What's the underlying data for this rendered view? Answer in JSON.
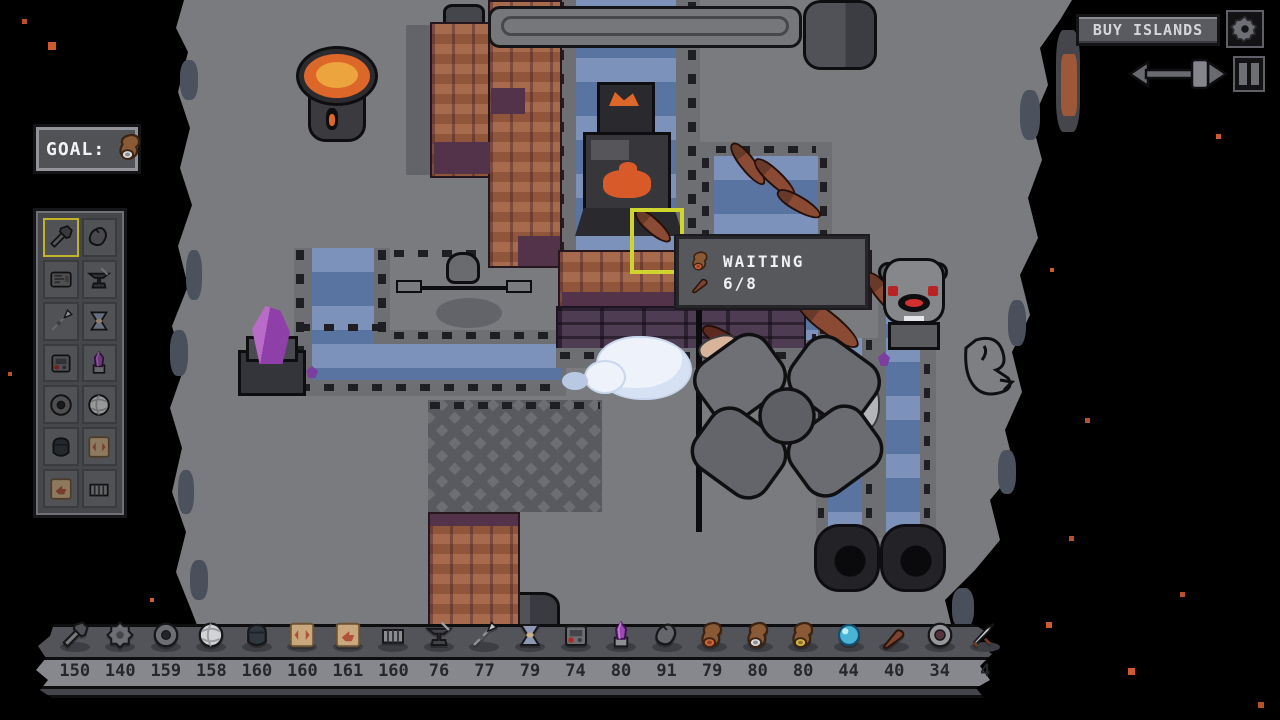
{
  "goal": {
    "label": "GOAL:",
    "item_icon": "bag-white"
  },
  "top_right": {
    "buy_islands_label": "BUY ISLANDS",
    "gear_icon": "settings-gear",
    "speed_slider_icon": "speed-slider",
    "pause_icon": "pause"
  },
  "tooltip": {
    "rows": [
      {
        "icon": "bag-orange",
        "text": "WAITING"
      },
      {
        "icon": "club",
        "text": "6/8"
      }
    ]
  },
  "sidebar": {
    "items": [
      {
        "icon": "hammer-tool",
        "selected": true
      },
      {
        "icon": "gray-pouch",
        "selected": false
      },
      {
        "icon": "machine",
        "selected": false
      },
      {
        "icon": "anvil",
        "selected": false
      },
      {
        "icon": "spear",
        "selected": false
      },
      {
        "icon": "spindle",
        "selected": false
      },
      {
        "icon": "grinder-red",
        "selected": false
      },
      {
        "icon": "purple-crystal",
        "selected": false
      },
      {
        "icon": "stone-wheel",
        "selected": false
      },
      {
        "icon": "wool-ball",
        "selected": false
      },
      {
        "icon": "bucket",
        "selected": false
      },
      {
        "icon": "card-slots",
        "selected": false
      },
      {
        "icon": "card-arrow",
        "selected": false
      },
      {
        "icon": "fence",
        "selected": false
      }
    ]
  },
  "bottom_bar": {
    "items": [
      {
        "icon": "hammer-tool",
        "count": "150"
      },
      {
        "icon": "gear-rock",
        "count": "140"
      },
      {
        "icon": "stone-wheel",
        "count": "159"
      },
      {
        "icon": "wool-ball",
        "count": "158"
      },
      {
        "icon": "bucket",
        "count": "160"
      },
      {
        "icon": "card-slots",
        "count": "160"
      },
      {
        "icon": "card-arrow",
        "count": "161"
      },
      {
        "icon": "fence",
        "count": "160"
      },
      {
        "icon": "anvil",
        "count": "76"
      },
      {
        "icon": "spear",
        "count": "77"
      },
      {
        "icon": "spindle",
        "count": "79"
      },
      {
        "icon": "grinder-red",
        "count": "74"
      },
      {
        "icon": "purple-crystal",
        "count": "80"
      },
      {
        "icon": "gray-pouch",
        "count": "91"
      },
      {
        "icon": "bag-orange",
        "count": "79"
      },
      {
        "icon": "bag-white",
        "count": "80"
      },
      {
        "icon": "bag-gold",
        "count": "80"
      },
      {
        "icon": "blue-orb",
        "count": "44"
      },
      {
        "icon": "club",
        "count": "40"
      },
      {
        "icon": "shield",
        "count": "34"
      },
      {
        "icon": "sword",
        "count": "4"
      }
    ]
  },
  "colors": {
    "selection_yellow": "#cfd42e",
    "water_blue": "#5a74a2",
    "brick_red": "#a05f40",
    "island_gray": "#7a7b7f",
    "star_red": "#c9552e",
    "panel_gray": "#55565c",
    "flame_orange": "#dd6629"
  }
}
